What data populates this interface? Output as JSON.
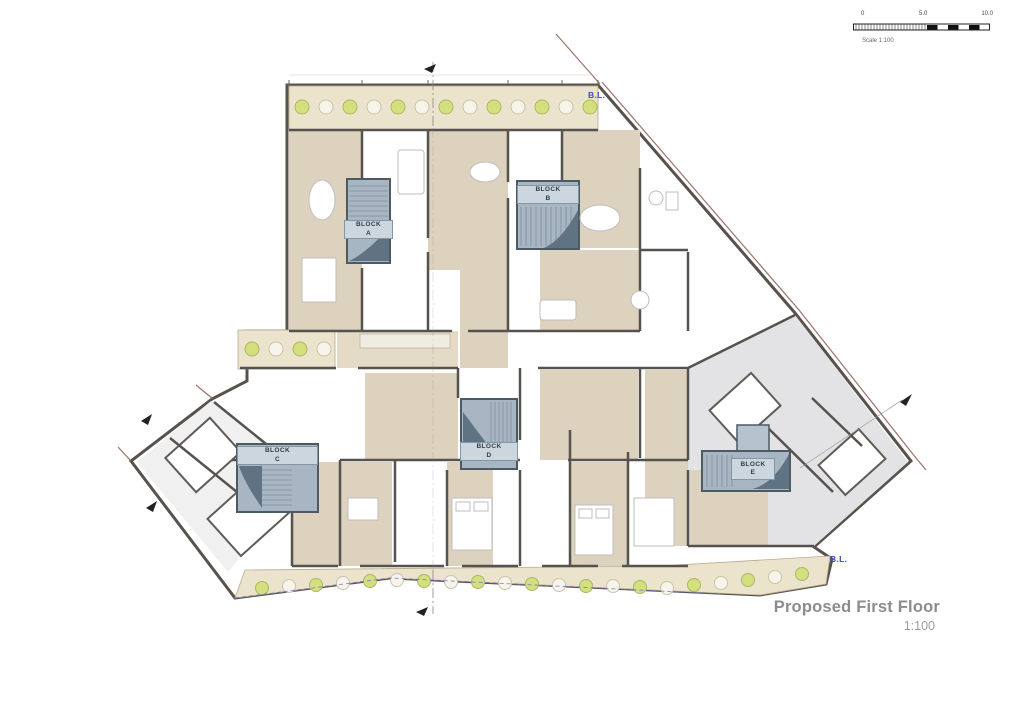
{
  "plan": {
    "title": "Proposed First Floor",
    "scale": "1:100"
  },
  "scale_bar": {
    "tick_zero": "0",
    "tick_mid": "5.0",
    "tick_end": "10.0",
    "caption": "Scale 1:100"
  },
  "boundary": {
    "label": "B.L."
  },
  "blocks": [
    {
      "name": "BLOCK",
      "letter": "A"
    },
    {
      "name": "BLOCK",
      "letter": "B"
    },
    {
      "name": "BLOCK",
      "letter": "C"
    },
    {
      "name": "BLOCK",
      "letter": "D"
    },
    {
      "name": "BLOCK",
      "letter": "E"
    }
  ],
  "colors": {
    "walls": "#55524f",
    "room_beige": "#ddd2bd",
    "deck": "#ece3cd",
    "room_gray": "#e3e3e6",
    "stair_core": "#a7b6c2",
    "stair_dark": "#5f7383",
    "planter_green": "#d4e07e",
    "boundary_line": "#8a5a50",
    "boundary_label_text": "#3b49c6",
    "title_text": "#8c8c8c"
  }
}
